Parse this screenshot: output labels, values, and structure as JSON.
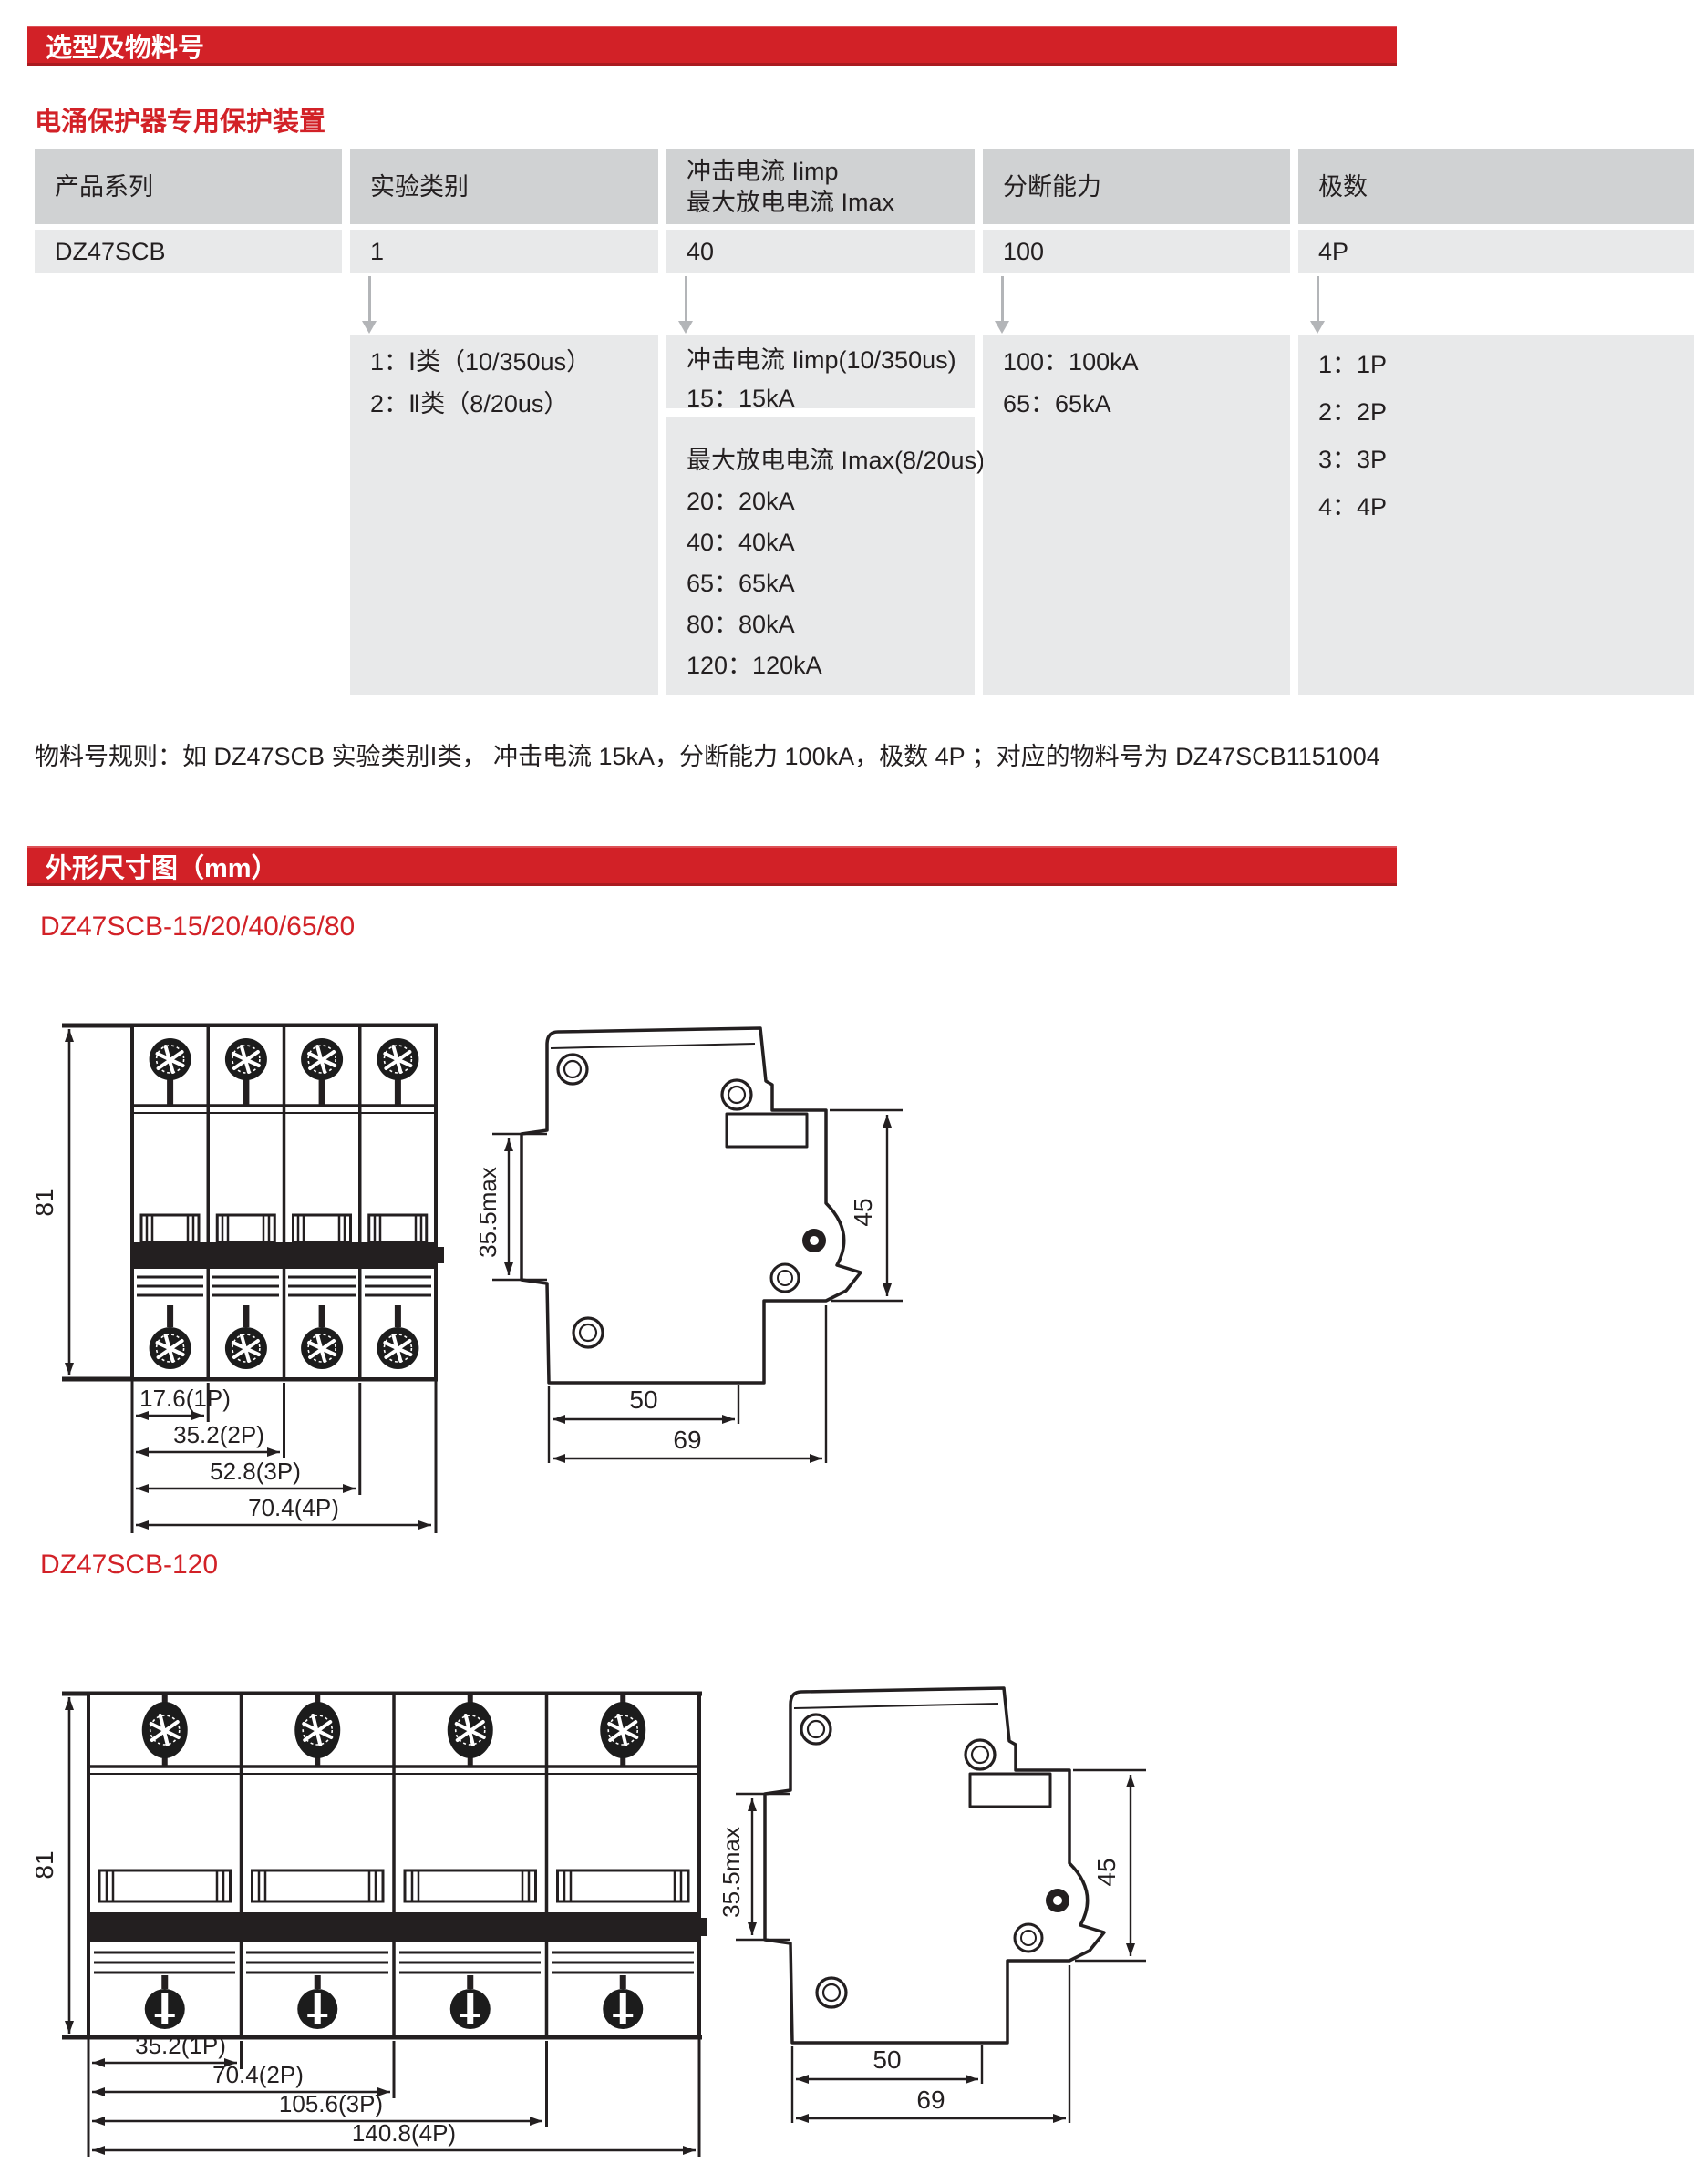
{
  "section1": {
    "title": "选型及物料号",
    "subtitle": "电涌保护器专用保护装置",
    "table": {
      "columns": [
        {
          "header": "产品系列",
          "value": "DZ47SCB"
        },
        {
          "header": "实验类别",
          "value": "1",
          "options": [
            "1：Ⅰ类（10/350us）",
            "2：Ⅱ类（8/20us）"
          ]
        },
        {
          "header_line1": "冲击电流 Iimp",
          "header_line2": "最大放电电流 Imax",
          "value": "40",
          "options_imp": [
            "冲击电流 Iimp(10/350us)",
            "15：15kA"
          ],
          "options_imax": [
            "最大放电电流 Imax(8/20us)",
            "20：20kA",
            "40：40kA",
            "65：65kA",
            "80：80kA",
            "120：120kA"
          ]
        },
        {
          "header": "分断能力",
          "value": "100",
          "options": [
            "100：100kA",
            "65：65kA"
          ]
        },
        {
          "header": "极数",
          "value": "4P",
          "options": [
            "1：1P",
            "2：2P",
            "3：3P",
            "4：4P"
          ]
        }
      ]
    },
    "rule_text": "物料号规则：如 DZ47SCB 实验类别Ⅰ类， 冲击电流 15kA，分断能力 100kA，极数 4P ；对应的物料号为 DZ47SCB1151004"
  },
  "section2": {
    "title": "外形尺寸图（mm）",
    "side_labels": [
      "35.5max",
      "45",
      "50",
      "69"
    ],
    "drawing1": {
      "caption": "DZ47SCB-15/20/40/65/80",
      "front": {
        "height_label": "81",
        "width_labels": [
          "17.6(1P)",
          "35.2(2P)",
          "52.8(3P)",
          "70.4(4P)"
        ]
      }
    },
    "drawing2": {
      "caption": "DZ47SCB-120",
      "front": {
        "height_label": "81",
        "width_labels": [
          "35.2(1P)",
          "70.4(2P)",
          "105.6(3P)",
          "140.8(4P)"
        ]
      }
    }
  },
  "colors": {
    "red": "#d22127",
    "header_gray": "#d0d2d3",
    "cell_gray": "#e8e9ea",
    "ink": "#231f20"
  }
}
